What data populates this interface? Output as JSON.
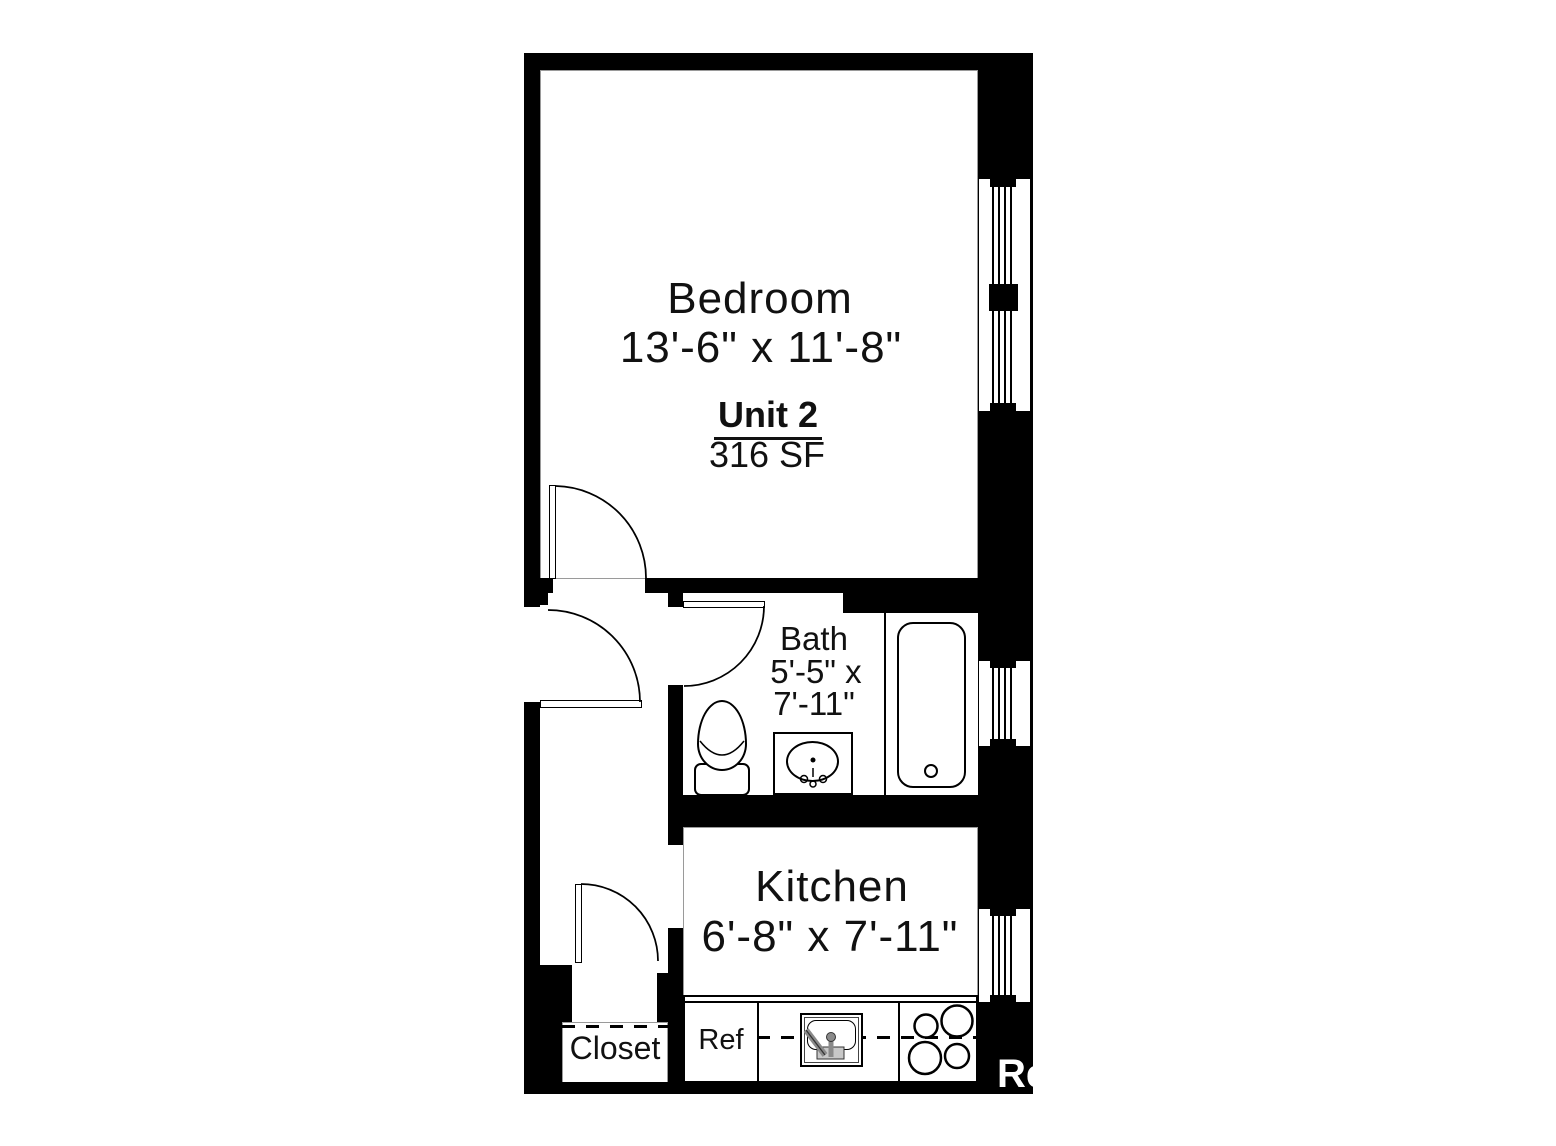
{
  "unit": {
    "name": "Unit 2",
    "area": "316 SF"
  },
  "rooms": {
    "bedroom": {
      "name": "Bedroom",
      "dimensions": "13'-6\" x 11'-8\""
    },
    "bath": {
      "name": "Bath",
      "dimensions_line1": "5'-5\" x",
      "dimensions_line2": "7'-11\""
    },
    "kitchen": {
      "name": "Kitchen",
      "dimensions": "6'-8\" x 7'-11\""
    },
    "closet": {
      "name": "Closet"
    }
  },
  "appliances": {
    "refrigerator": "Ref"
  },
  "watermark": {
    "visible_text": "Re"
  },
  "colors": {
    "wall": "#000000",
    "floor": "#ffffff",
    "watermark_text": "#ffffff",
    "fixture_metal": "#8a8a8a"
  }
}
